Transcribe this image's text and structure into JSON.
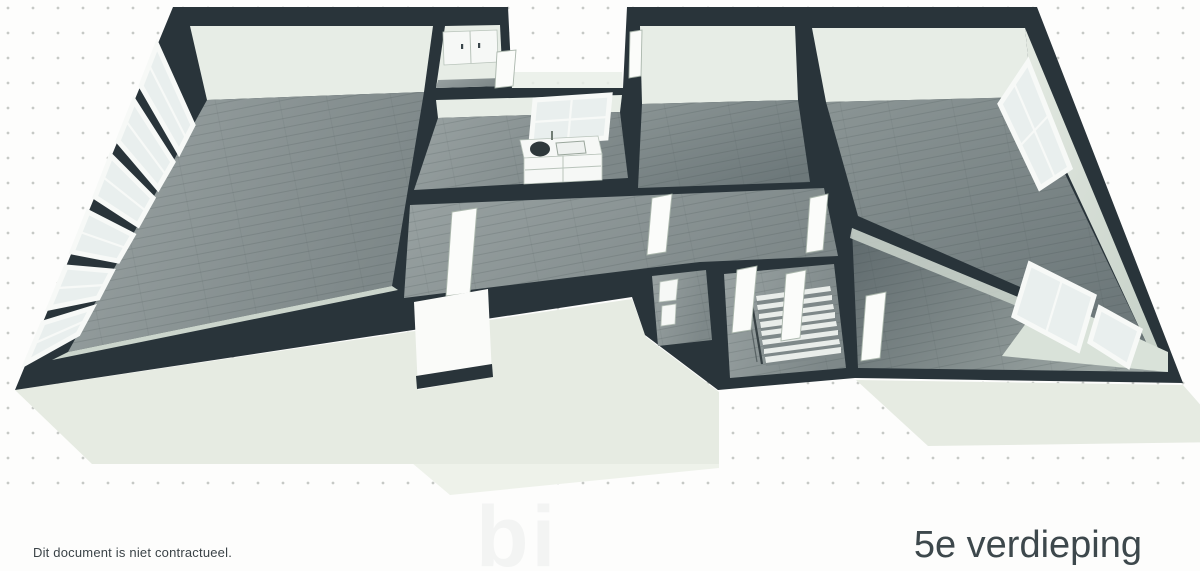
{
  "page": {
    "width": 1200,
    "height": 571
  },
  "labels": {
    "disclaimer": "Dit document is niet contractueel.",
    "floor": "5e verdieping",
    "watermark": "bi"
  },
  "colors": {
    "bg": "#fdfdfc",
    "dot": "#c6c9c6",
    "wall": "#29343a",
    "wall-face": "#e7ede6",
    "wall-face-side": "#d9e2d9",
    "wall-face-low": "#cbd5cc",
    "floor-light": "#8e9798",
    "floor-mid": "#7f8a8b",
    "floor-dark": "#657073",
    "slab": "#e6ebe2",
    "slab-light": "#eef2ea",
    "window-frame": "#f7f9f7",
    "glass": "#e9efee",
    "door": "#fbfcfa",
    "door-edge": "#aab6ac",
    "text": "#3b4347",
    "title": "#3d484c",
    "watermark": "#f3f4f3"
  }
}
